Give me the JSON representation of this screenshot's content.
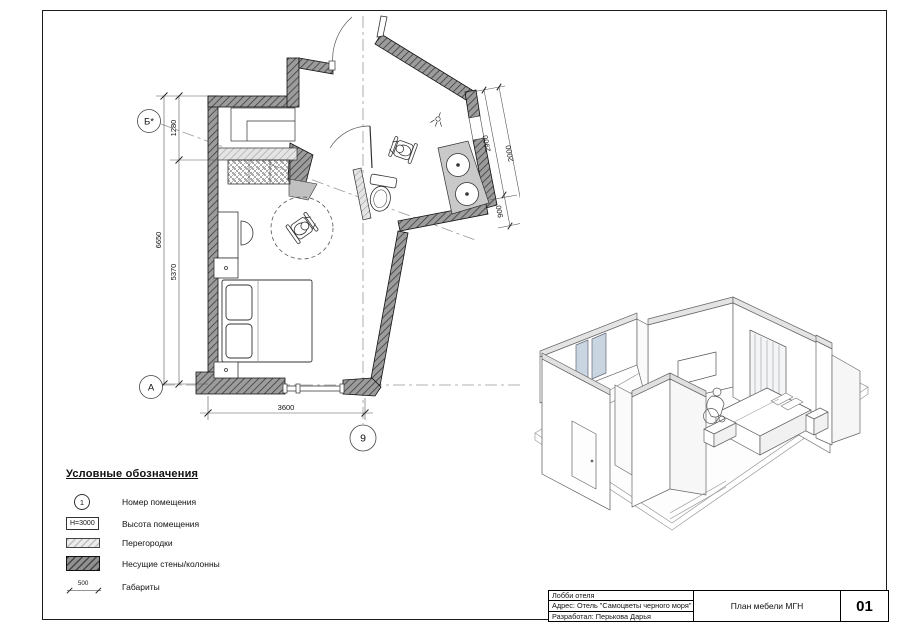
{
  "plan": {
    "grid": {
      "axis_b": "Б*",
      "axis_a": "А",
      "axis_9": "9"
    },
    "dimensions": {
      "niche_height": "1280",
      "left_total": "6650",
      "left_room": "5370",
      "bottom_width": "3600",
      "bath_side_inner": "2900",
      "bath_side_outer": "2000",
      "bath_side_small": "900"
    }
  },
  "legend": {
    "title": "Условные обозначения",
    "items": [
      {
        "id": "room-number",
        "symbol": "1",
        "label": "Номер помещения"
      },
      {
        "id": "room-height",
        "symbol": "H=3000",
        "label": "Высота помещения"
      },
      {
        "id": "partition",
        "symbol": "",
        "label": "Перегородки"
      },
      {
        "id": "bearing-wall",
        "symbol": "",
        "label": "Несущие стены/колонны"
      },
      {
        "id": "dimension",
        "symbol": "500",
        "label": "Габариты"
      }
    ]
  },
  "titleblock": {
    "project": "Лобби отеля",
    "address": "Адрес: Отель \"Самоцветы черного моря\"",
    "author": "Разработал: Перькова Дарья",
    "sheet_title": "План мебели МГН",
    "sheet_number": "01"
  }
}
